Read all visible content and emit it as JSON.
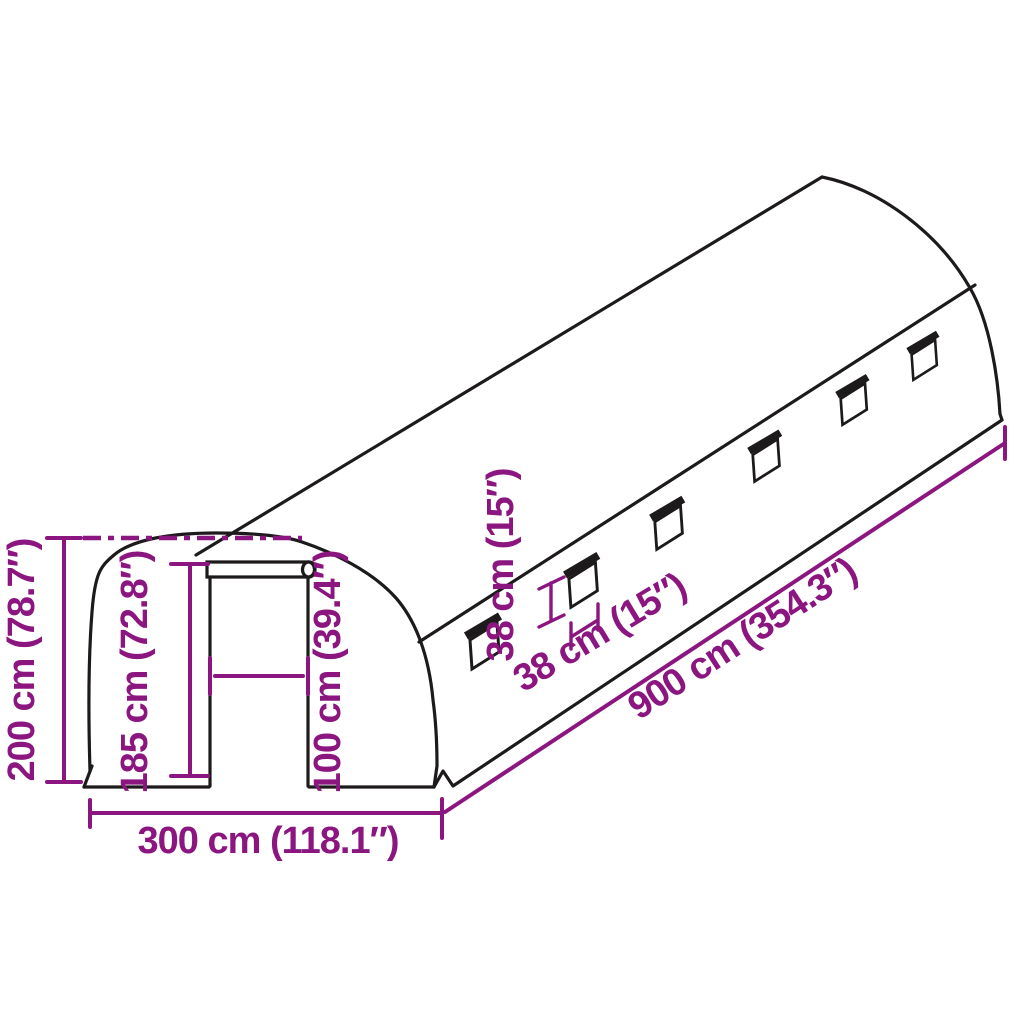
{
  "diagram": {
    "subject": "polytunnel-greenhouse-dimension-diagram",
    "colors": {
      "outline": "#1d1a1b",
      "dimension": "#8C1680",
      "background": "#ffffff"
    },
    "labels": {
      "total_height": "200 cm (78.7″)",
      "door_height": "185 cm (72.8″)",
      "door_width": "100 cm (39.4″)",
      "window_height": "38 cm (15″)",
      "window_width": "38 cm (15″)",
      "length": "900 cm (354.3″)",
      "width": "300 cm (118.1″)"
    },
    "window_count": 6
  }
}
